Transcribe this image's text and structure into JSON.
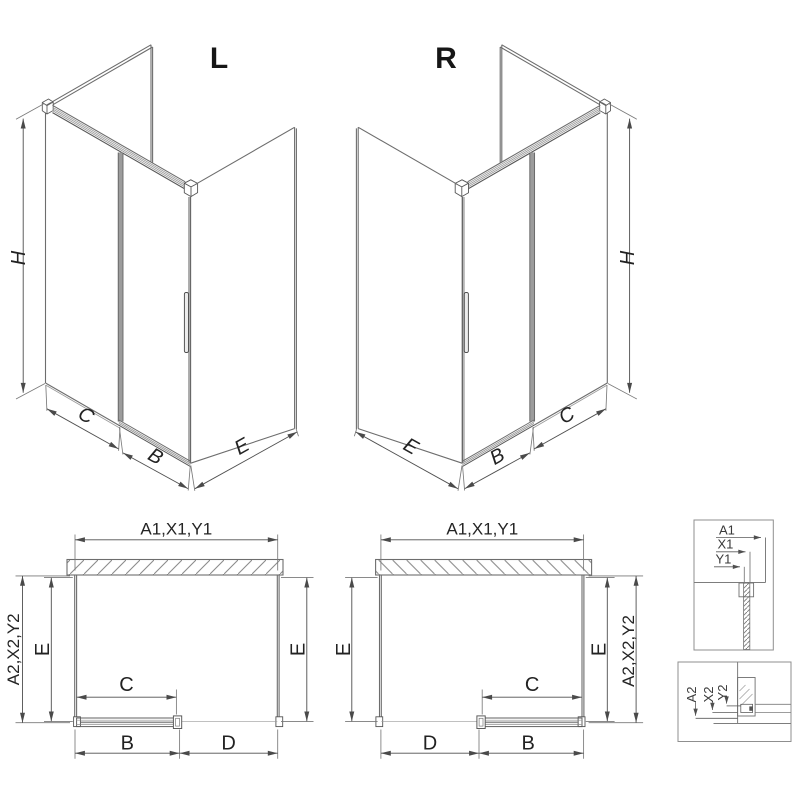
{
  "drawing": {
    "type": "shower-enclosure-dimension-diagram",
    "colors": {
      "background": "#ffffff",
      "line": "#6d6d6d",
      "dim_line": "#4f4f4f",
      "text": "#1c1c1c",
      "profile_gray": "#9c9c9c",
      "hatch": "#8c8c8c"
    },
    "views": {
      "iso_left": {
        "label": "L",
        "dim_height": "H",
        "dim_fixed_panel": "C",
        "dim_door": "B",
        "dim_side_panel": "E"
      },
      "iso_right": {
        "label": "R",
        "dim_height": "H",
        "dim_fixed_panel": "C",
        "dim_door": "B",
        "dim_side_panel": "E"
      },
      "plan_left": {
        "dim_width_top": "A1,X1,Y1",
        "dim_depth_outer": "A2,X2,Y2",
        "dim_depth_left": "E",
        "dim_depth_right": "E",
        "dim_door_travel": "C",
        "dim_bottom_left": "B",
        "dim_bottom_right": "D"
      },
      "plan_right": {
        "dim_width_top": "A1,X1,Y1",
        "dim_depth_outer": "A2,X2,Y2",
        "dim_depth_left": "E",
        "dim_depth_right": "E",
        "dim_door_travel": "C",
        "dim_bottom_left": "D",
        "dim_bottom_right": "B"
      },
      "detail_wall_profile": {
        "dim_1": "A1",
        "dim_2": "X1",
        "dim_3": "Y1"
      },
      "detail_floor_profile": {
        "dim_1": "A2",
        "dim_2": "X2",
        "dim_3": "Y2"
      }
    }
  }
}
